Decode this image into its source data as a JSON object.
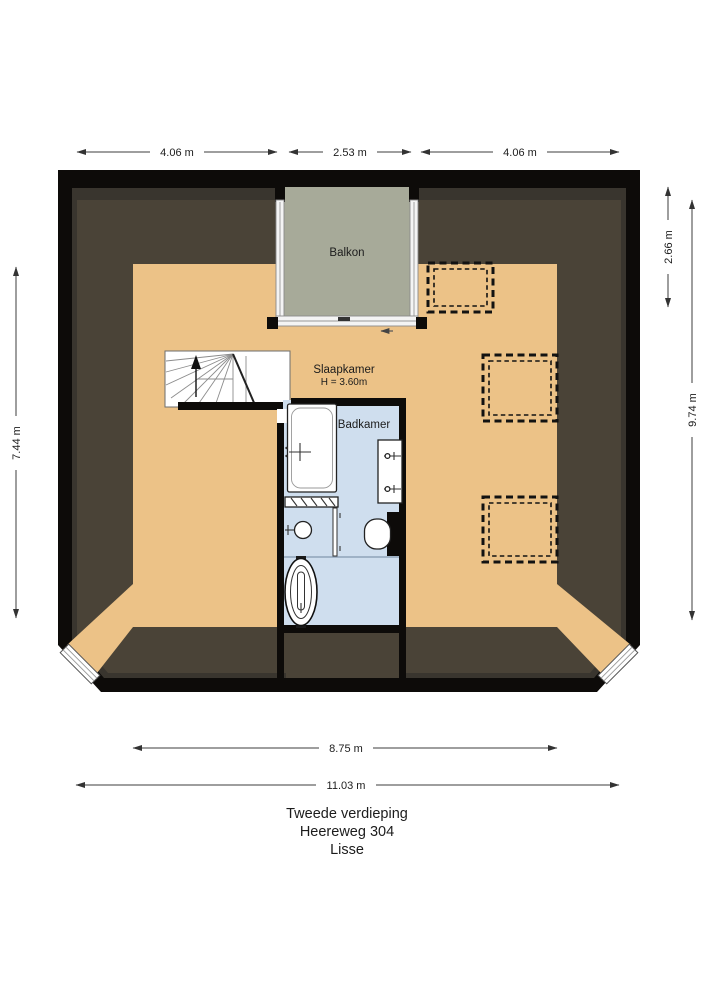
{
  "floorplan": {
    "address_title": {
      "floor": "Tweede verdieping",
      "street": "Heereweg 304",
      "city": "Lisse"
    },
    "rooms": {
      "balcony": {
        "label": "Balkon"
      },
      "bedroom": {
        "label": "Slaapkamer",
        "ceiling_height": "H = 3.60m"
      },
      "bathroom": {
        "label": "Badkamer"
      }
    },
    "dimensions": {
      "top_left": "4.06 m",
      "top_center": "2.53 m",
      "top_right": "4.06 m",
      "side_left": "7.44 m",
      "right_inner": "2.66 m",
      "right_outer": "9.74 m",
      "bottom_inner": "8.75 m",
      "bottom_outer": "11.03 m"
    },
    "icons": {
      "stairs_direction": "up-arrow",
      "balcony_door": "slide-left-arrow",
      "skylights": "dashed-roof-window",
      "bath_tap": "faucet-cross",
      "shower": "shower-head",
      "vanity_taps": "faucet"
    },
    "colors": {
      "wall": "#0d0b09",
      "wall_inner_band": "#39352e",
      "roof": "#4a4337",
      "floor": "#ecc287",
      "balcony": "#a7aa99",
      "bathroom": "#cfdeee"
    }
  }
}
